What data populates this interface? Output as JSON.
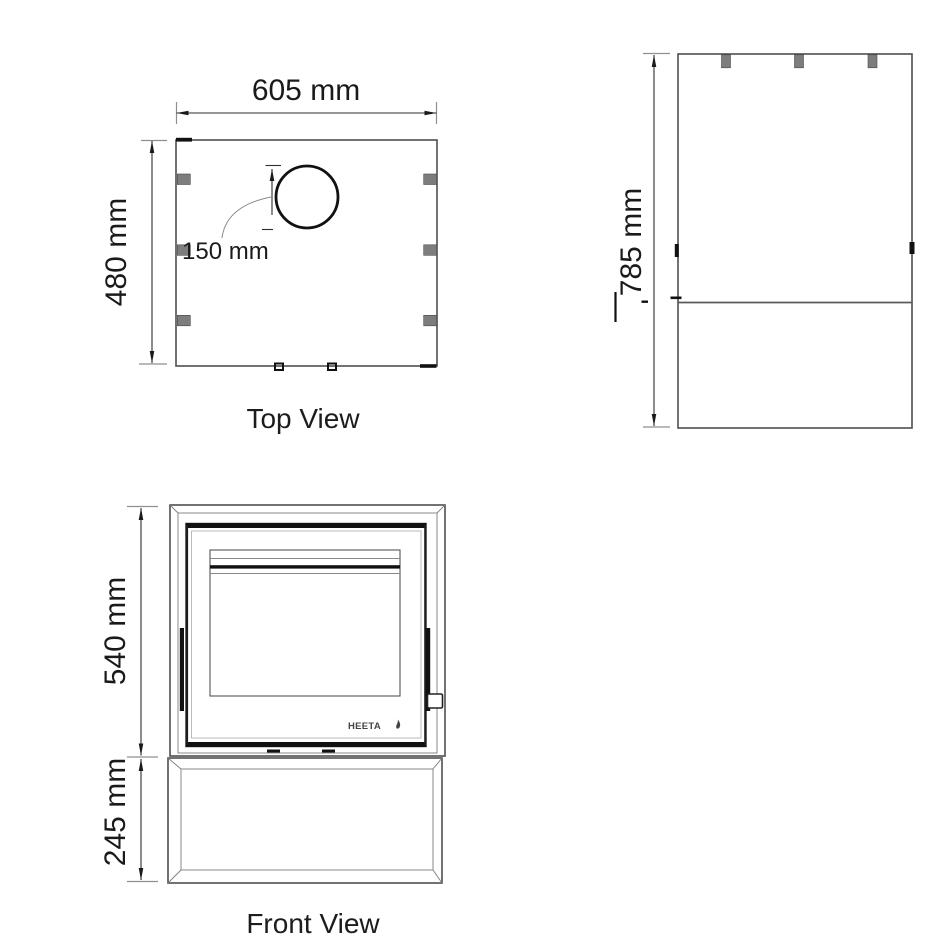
{
  "colors": {
    "line": "#4f4f4f",
    "dark_detail": "#111111",
    "tab_gray": "#7d7d7d",
    "text": "#1a1a1a"
  },
  "top_view": {
    "label": "Top View",
    "width_dim": "605 mm",
    "depth_dim": "480 mm",
    "flue_offset_dim": "150 mm"
  },
  "side_view": {
    "height_dim": "785 mm"
  },
  "front_view": {
    "label": "Front View",
    "firebox_height_dim": "540 mm",
    "stand_height_dim": "245 mm",
    "logo_text": "HEETA"
  }
}
